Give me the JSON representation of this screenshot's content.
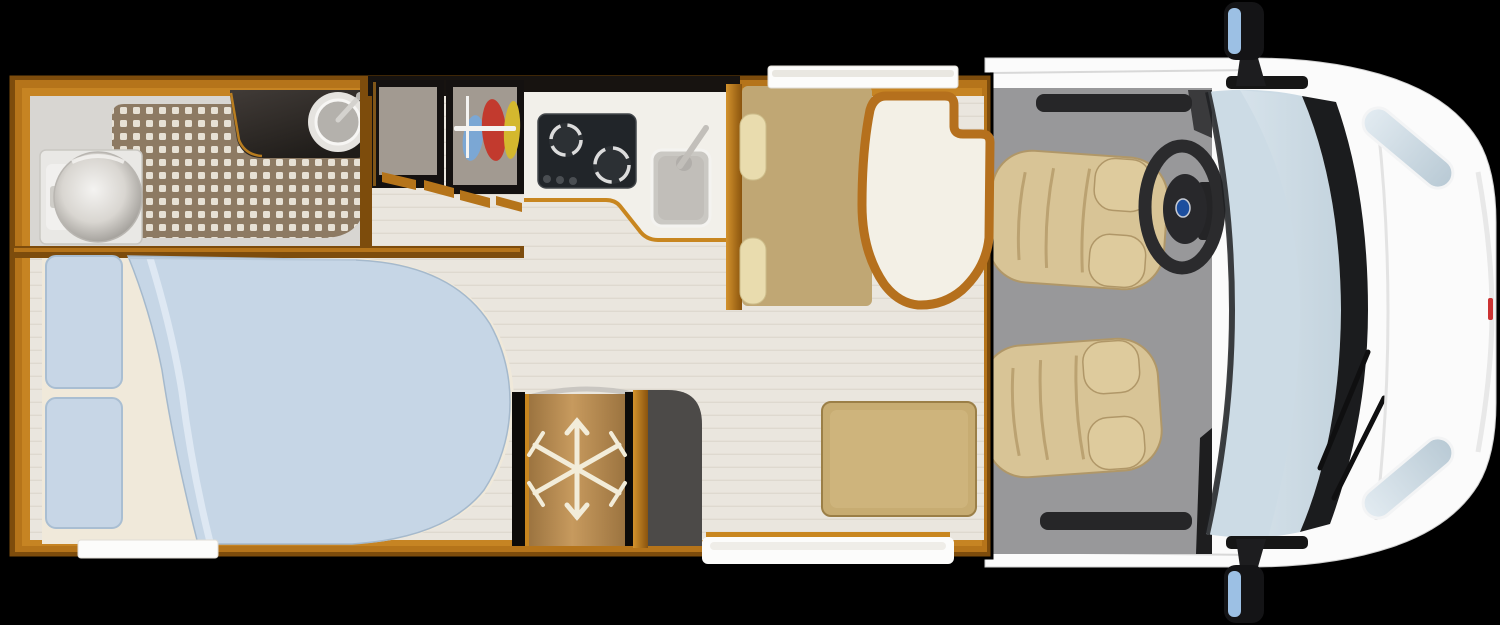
{
  "scene": {
    "name": "motorhome-floor-plan",
    "view": "top-down",
    "areas": [
      "bathroom",
      "bedroom",
      "wardrobes",
      "kitchen",
      "dinette",
      "fridge",
      "cab"
    ]
  },
  "colors": {
    "background": "#000000",
    "wood_wall": "#b5741a",
    "wood_wall_dark": "#7d4c0c",
    "wood_highlight": "#d3922c",
    "floor": "#eae6de",
    "bathroom_floor": "#d8d6d2",
    "shower_tile": "#8d7a63",
    "tile_dot": "#efeadf",
    "counter_dark": "#332e2a",
    "toilet": "#e9e8e5",
    "basin": "#b4b1ac",
    "stove": "#212529",
    "kitchen_counter": "#f2f0ea",
    "sink_steel": "#cac8c3",
    "wardrobe_interior": "#a29a91",
    "cloth_blue": "#7ba7d4",
    "cloth_red": "#c23a2e",
    "cloth_yellow": "#d4b82e",
    "bench": "#c4ab78",
    "bench_cushion": "#e9dcae",
    "table_top": "#f3f0e6",
    "table_rim": "#b5701d",
    "mattress": "#f0e9da",
    "pillow": "#c7d6e6",
    "duvet": "#c6d6e6",
    "fridge_wood": "#b58a50",
    "snowflake": "#f2ecd9",
    "side_unit_gray": "#4c4a48",
    "ottoman": "#c7ac72",
    "cab_floor": "#98989a",
    "cab_trim_dark": "#262628",
    "seat": "#d8c496",
    "steering_wheel": "#2b2b2d",
    "badge_blue": "#1c4e9e",
    "vehicle_body": "#fbfbfb",
    "windshield": "#ccdbe5",
    "wiper_black": "#1b1c1e",
    "mirror_glass": "#9cc0e4",
    "door_white": "#fcfcfb",
    "marker_red": "#cc3333"
  }
}
